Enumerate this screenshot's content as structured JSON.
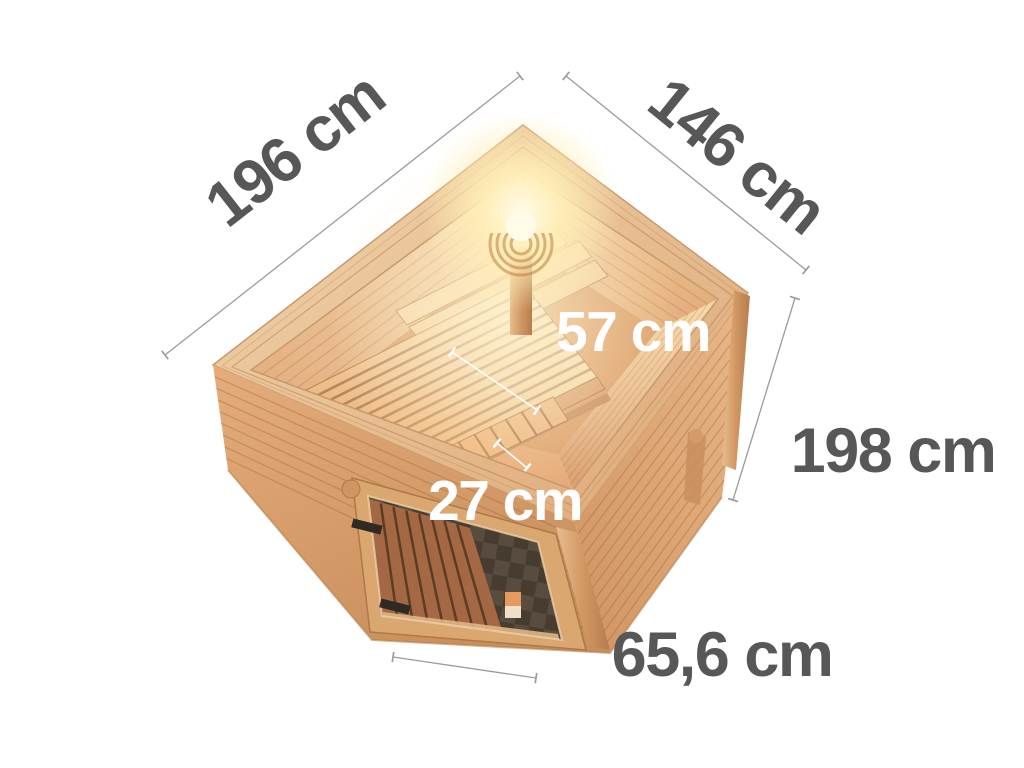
{
  "dimensions": {
    "outer_length": "196 cm",
    "outer_width": "146 cm",
    "wall_height": "198 cm",
    "bench_depth": "57 cm",
    "lower_bench_depth": "27 cm",
    "door_width": "65,6 cm"
  },
  "colors": {
    "label_text": "#575757",
    "interior_label_text": "#ffffff",
    "dimension_line": "#9b9b9b",
    "wood_light": "#f3d2a4",
    "wood_mid": "#e2ae7d",
    "wood_dark": "#c98f5f",
    "glass": "#463c30",
    "lamp_glow": "#ffeeb6",
    "background": "#ffffff"
  }
}
